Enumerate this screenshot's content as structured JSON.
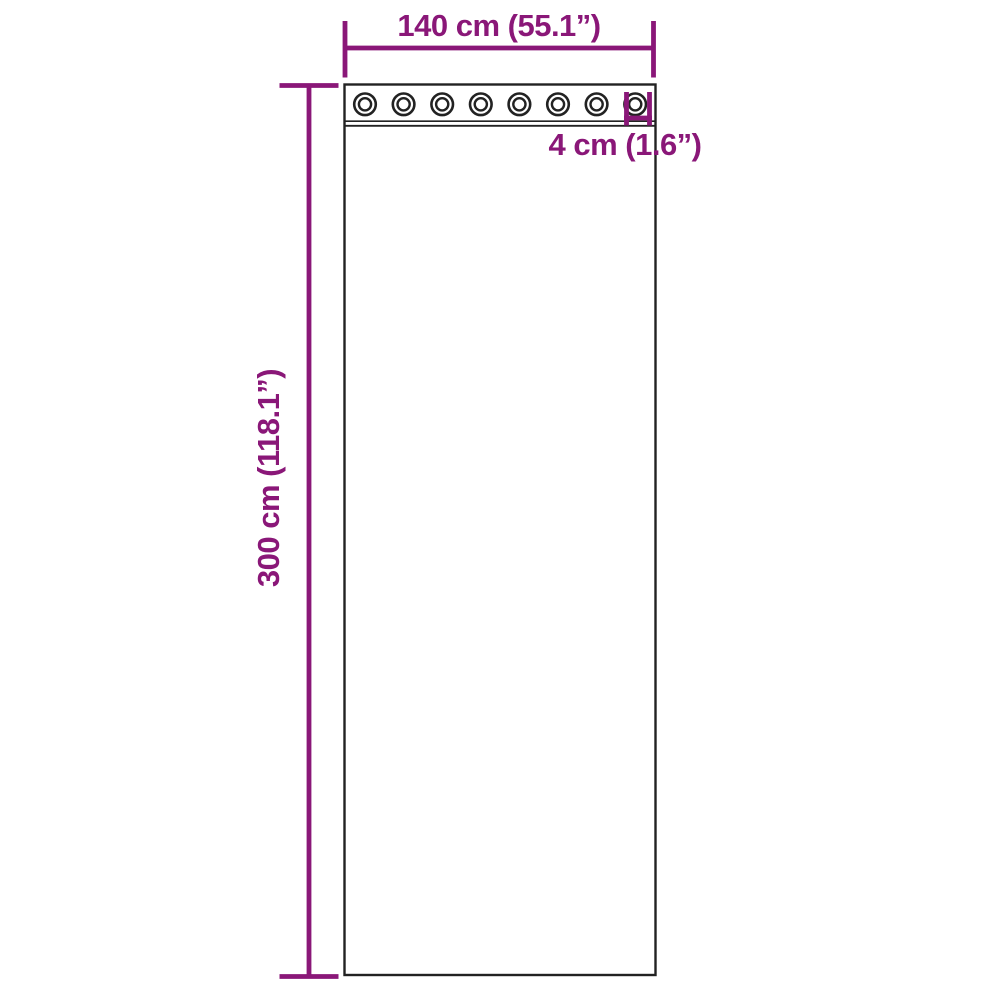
{
  "figure": {
    "kind": "product-dimension-diagram",
    "subject": "curtain panel with grommet top",
    "background_color": "#ffffff",
    "outline_color": "#222222",
    "dimension_color": "#8a1778",
    "grommet_count": 8,
    "labels": {
      "width": "140 cm (55.1”)",
      "height": "300 cm (118.1”)",
      "grommet_diameter": "4 cm (1.6”)"
    },
    "dimensions": [
      {
        "name": "width",
        "cm": 140,
        "inches": 55.1
      },
      {
        "name": "height",
        "cm": 300,
        "inches": 118.1
      },
      {
        "name": "grommet-diameter",
        "cm": 4,
        "inches": 1.6
      }
    ]
  }
}
